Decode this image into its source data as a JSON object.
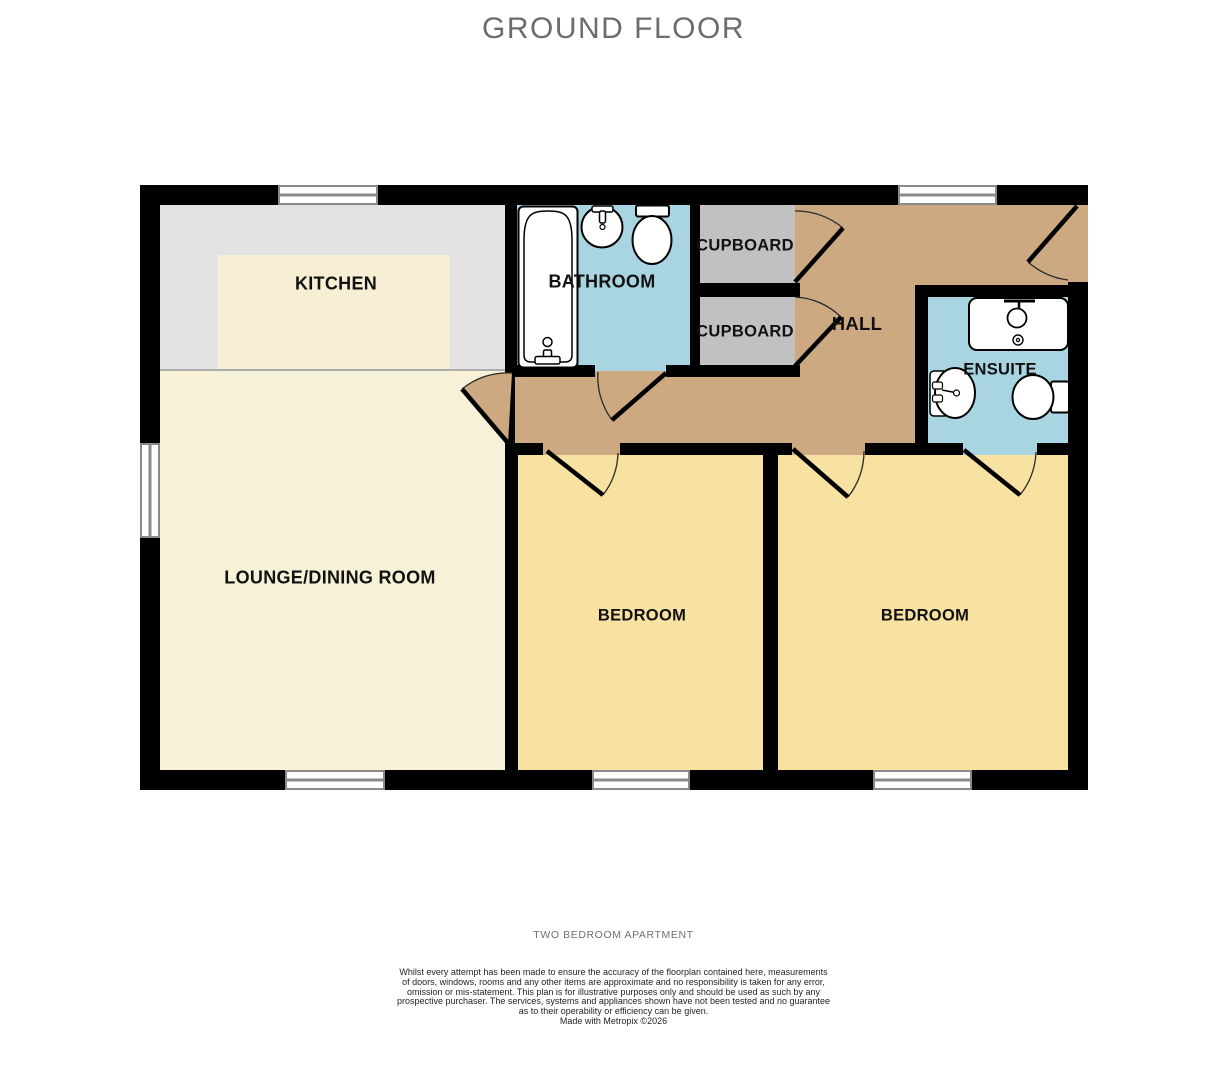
{
  "title": "GROUND FLOOR",
  "rooms": {
    "kitchen": {
      "label": "KITCHEN"
    },
    "bathroom": {
      "label": "BATHROOM"
    },
    "cupboard_top": {
      "label": "CUPBOARD"
    },
    "cupboard_bottom": {
      "label": "CUPBOARD"
    },
    "hall": {
      "label": "HALL"
    },
    "ensuite": {
      "label": "ENSUITE"
    },
    "lounge": {
      "label": "LOUNGE/DINING ROOM"
    },
    "bedroom_left": {
      "label": "BEDROOM"
    },
    "bedroom_right": {
      "label": "BEDROOM"
    }
  },
  "fixtures": {
    "bathroom": [
      "bathtub",
      "sink",
      "toilet"
    ],
    "ensuite": [
      "shower",
      "sink",
      "toilet"
    ]
  },
  "colors": {
    "wall": "#000000",
    "kitchen_floor": "#e3e3e3",
    "worktop_cream": "#f6efd4",
    "lounge_floor": "#f7f1d7",
    "bedroom_floor": "#f7e2a2",
    "hall_floor": "#cca981",
    "bathroom_floor": "#a9d4e1",
    "cupboard_floor": "#c1c1c1",
    "title_text": "#6c6c6c"
  },
  "footer": {
    "caption": "TWO BEDROOM APARTMENT",
    "disclaimer_lines": [
      "Whilst every attempt has been made to ensure the accuracy of the floorplan contained here, measurements",
      "of doors, windows, rooms and any other items are approximate and no responsibility is taken for any error,",
      "omission or mis-statement. This plan is for illustrative purposes only and should be used as such by any",
      "prospective purchaser. The services, systems and appliances shown have not been tested and no guarantee",
      "as to their operability or efficiency can be given."
    ],
    "credit": "Made with Metropix ©2026"
  }
}
